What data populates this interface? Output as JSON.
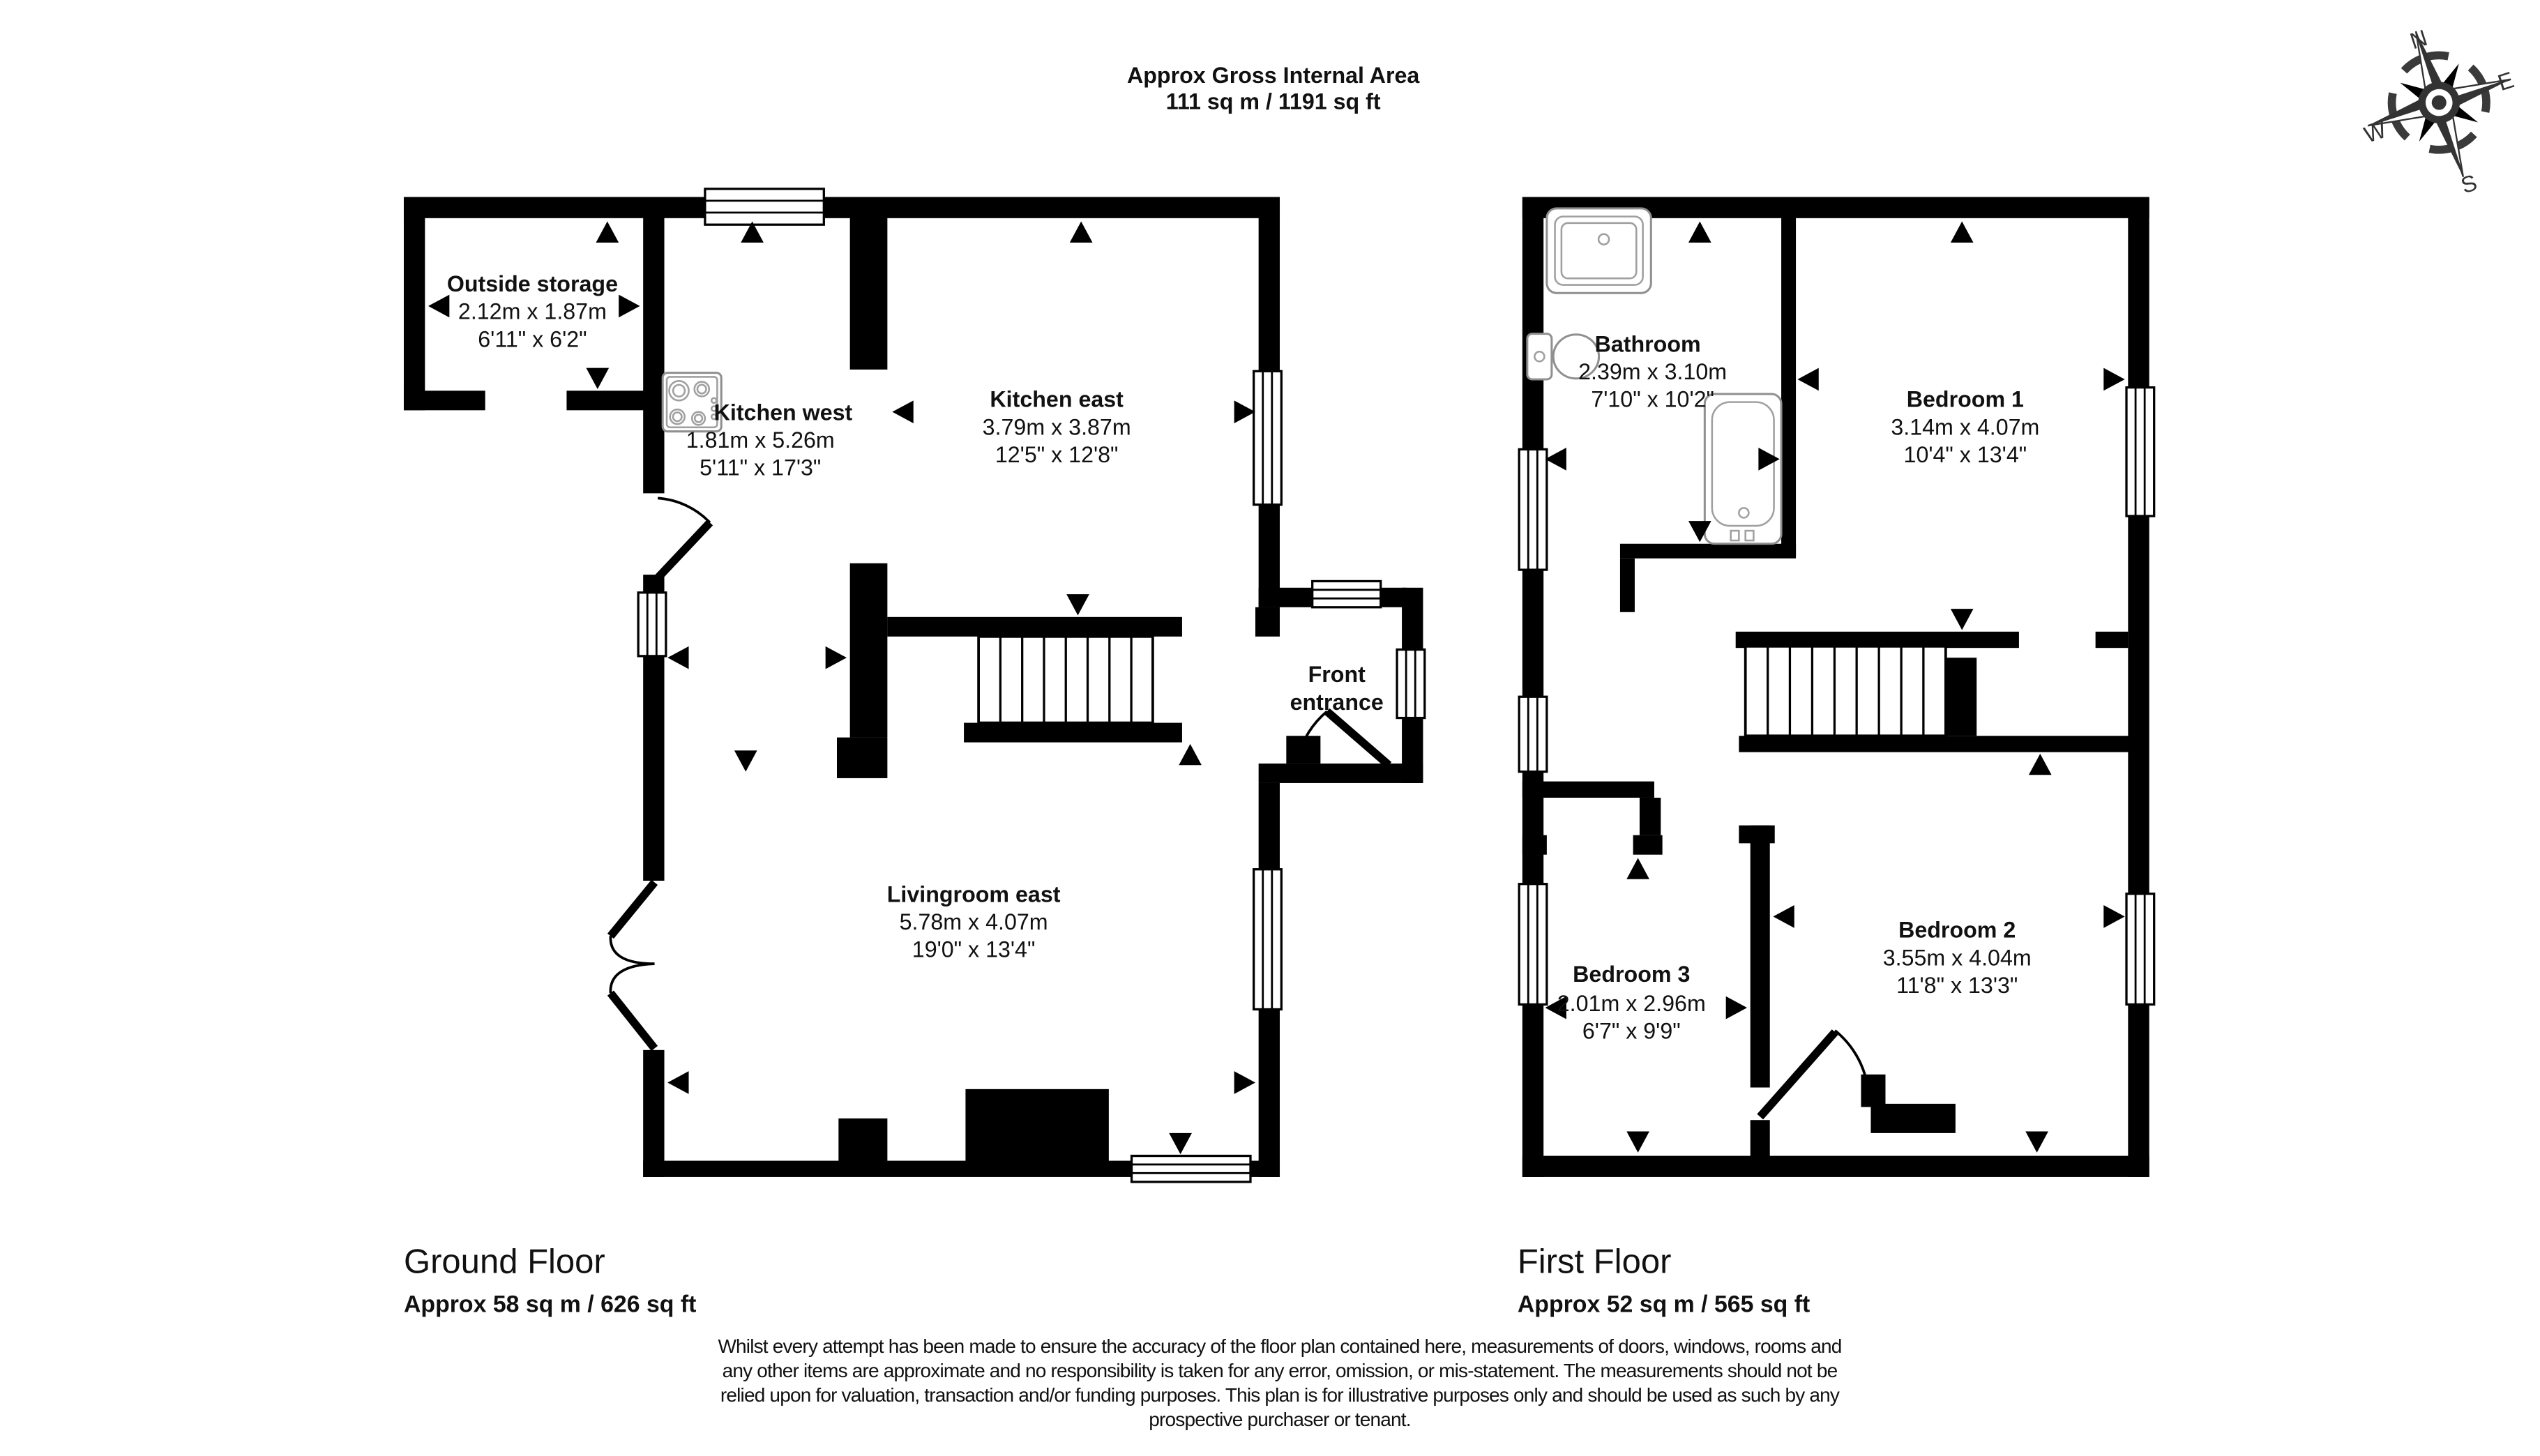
{
  "header": {
    "title_line1": "Approx Gross Internal Area",
    "title_line2": "111 sq m / 1191 sq ft"
  },
  "compass": {
    "north": "N",
    "east": "E",
    "south": "S",
    "west": "W"
  },
  "ground_floor": {
    "label": "Ground Floor",
    "area": "Approx 58 sq m / 626 sq ft",
    "rooms": {
      "outside_storage": {
        "name": "Outside storage",
        "metric": "2.12m x 1.87m",
        "imperial": "6'11\" x 6'2\""
      },
      "kitchen_west": {
        "name": "Kitchen west",
        "metric": "1.81m x 5.26m",
        "imperial": "5'11\" x 17'3\""
      },
      "kitchen_east": {
        "name": "Kitchen east",
        "metric": "3.79m x 3.87m",
        "imperial": "12'5\" x 12'8\""
      },
      "livingroom_east": {
        "name": "Livingroom east",
        "metric": "5.78m x 4.07m",
        "imperial": "19'0\" x 13'4\""
      },
      "front_entrance": {
        "name_line1": "Front",
        "name_line2": "entrance"
      }
    }
  },
  "first_floor": {
    "label": "First Floor",
    "area": "Approx 52 sq m / 565 sq ft",
    "rooms": {
      "bathroom": {
        "name": "Bathroom",
        "metric": "2.39m x 3.10m",
        "imperial": "7'10\" x 10'2\""
      },
      "bedroom_1": {
        "name": "Bedroom 1",
        "metric": "3.14m x 4.07m",
        "imperial": "10'4\" x 13'4\""
      },
      "bedroom_2": {
        "name": "Bedroom 2",
        "metric": "3.55m x 4.04m",
        "imperial": "11'8\" x 13'3\""
      },
      "bedroom_3": {
        "name": "Bedroom 3",
        "metric": "2.01m x 2.96m",
        "imperial": "6'7\" x 9'9\""
      }
    }
  },
  "disclaimer": {
    "line1": "Whilst every attempt has been made to ensure the accuracy of the floor plan contained here, measurements of doors, windows, rooms and",
    "line2": "any other items are approximate and no responsibility is taken for any error, omission, or mis-statement. The measurements should not be",
    "line3": "relied upon for valuation, transaction and/or funding purposes. This plan is for illustrative purposes only and should be used as such by any",
    "line4": "prospective purchaser or tenant."
  }
}
